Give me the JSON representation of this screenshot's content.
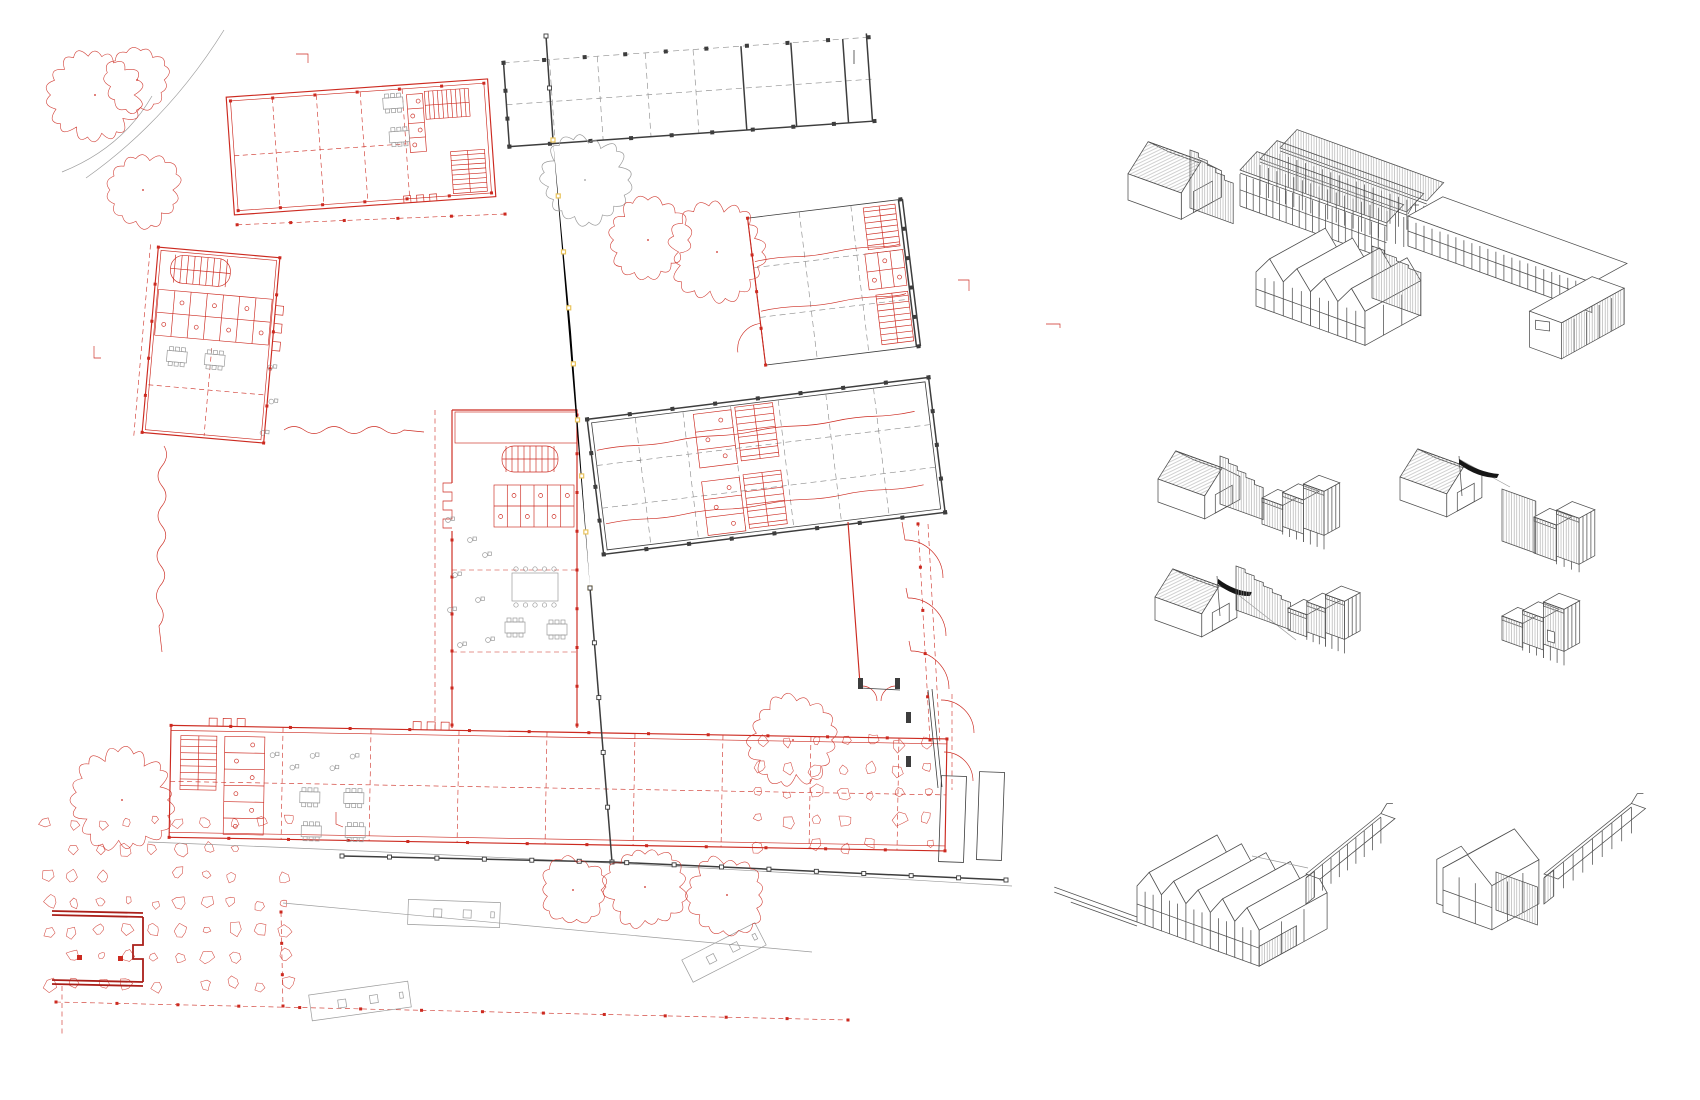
{
  "drawing": {
    "kind": "architectural site plan with axonometric massing studies",
    "visible_text": []
  },
  "colors": {
    "background": "#ffffff",
    "plan_red": "#cc2a20",
    "plan_dark_red": "#aa1f19",
    "boundary_yellow": "#e9c35b",
    "line_black": "#3d3d3d",
    "line_gray": "#9b9b9b",
    "axon_line": "#4e4e4e",
    "axon_hatch": "#a0a0a0",
    "flag_black": "#161616"
  },
  "site_plan": {
    "trees": [
      {
        "x": 95,
        "y": 95,
        "r": 42,
        "c": "red"
      },
      {
        "x": 137,
        "y": 80,
        "r": 30,
        "c": "red"
      },
      {
        "x": 143,
        "y": 190,
        "r": 34,
        "c": "red"
      },
      {
        "x": 585,
        "y": 180,
        "r": 40,
        "c": "gray"
      },
      {
        "x": 648,
        "y": 240,
        "r": 38,
        "c": "red"
      },
      {
        "x": 717,
        "y": 252,
        "r": 44,
        "c": "red"
      },
      {
        "x": 122,
        "y": 800,
        "r": 46,
        "c": "red"
      },
      {
        "x": 793,
        "y": 740,
        "r": 40,
        "c": "red"
      },
      {
        "x": 573,
        "y": 890,
        "r": 30,
        "c": "red"
      },
      {
        "x": 645,
        "y": 887,
        "r": 38,
        "c": "red"
      },
      {
        "x": 727,
        "y": 895,
        "r": 36,
        "c": "red"
      }
    ],
    "paving_fields": [
      {
        "x": 48,
        "y": 822,
        "cols": 10,
        "rows": 7,
        "dx": 26.5,
        "dy": 27,
        "seed": 5
      },
      {
        "x": 760,
        "y": 742,
        "cols": 7,
        "rows": 5,
        "dx": 28,
        "dy": 26,
        "seed": 9
      }
    ],
    "boundary_segments": [
      {
        "pts": [
          [
            546,
            36
          ],
          [
            553,
            140
          ]
        ],
        "cls": "k",
        "post": "ksq",
        "n": 2
      },
      {
        "pts": [
          [
            553,
            140
          ],
          [
            571,
            332
          ],
          [
            590,
            588
          ]
        ],
        "cls": "y",
        "post": "ysq",
        "n": 8
      },
      {
        "pts": [
          [
            590,
            588
          ],
          [
            612,
            862
          ]
        ],
        "cls": "k",
        "post": "ksq",
        "n": 5
      }
    ],
    "fences": [
      {
        "pts": [
          [
            342,
            856
          ],
          [
            612,
            862
          ],
          [
            1006,
            880
          ]
        ],
        "cls": "k",
        "post": "ksq",
        "n": 14
      }
    ],
    "stairs": [
      {
        "g": "gB1",
        "x": 428,
        "y": 96,
        "w": 44,
        "h": 28,
        "n": 9,
        "dir": "v"
      },
      {
        "g": "gB1",
        "x": 450,
        "y": 158,
        "w": 34,
        "h": 42,
        "n": 8,
        "dir": "h"
      },
      {
        "g": "gB3",
        "x": 164,
        "y": 258,
        "w": 60,
        "h": 28,
        "n": 9,
        "dir": "v",
        "rx": 13
      },
      {
        "g": "gMain",
        "x": 502,
        "y": 446,
        "w": 56,
        "h": 26,
        "n": 9,
        "dir": "v",
        "rx": 12
      },
      {
        "g": "gBot",
        "x": 180,
        "y": 742,
        "w": 36,
        "h": 54,
        "n": 8,
        "dir": "h"
      },
      {
        "g": "gB5",
        "x": 742,
        "y": 404,
        "w": 38,
        "h": 54,
        "n": 8,
        "dir": "h"
      },
      {
        "g": "gB5",
        "x": 742,
        "y": 472,
        "w": 38,
        "h": 54,
        "n": 8,
        "dir": "h"
      },
      {
        "g": "gB6",
        "x": 872,
        "y": 212,
        "w": 32,
        "h": 42,
        "n": 7,
        "dir": "h"
      },
      {
        "g": "gB6",
        "x": 874,
        "y": 300,
        "w": 32,
        "h": 50,
        "n": 8,
        "dir": "h"
      }
    ],
    "wcs": [
      {
        "g": "gB1",
        "x": 410,
        "y": 98,
        "w": 16,
        "h": 58,
        "stalls": 4,
        "dir": "v"
      },
      {
        "g": "gB3",
        "x": 154,
        "y": 294,
        "w": 114,
        "h": 46,
        "stalls": 7,
        "dir": "h"
      },
      {
        "g": "gMain",
        "x": 494,
        "y": 485,
        "w": 80,
        "h": 42,
        "stalls": 6,
        "dir": "h"
      },
      {
        "g": "gBot",
        "x": 224,
        "y": 742,
        "w": 40,
        "h": 98,
        "stalls": 6,
        "dir": "v"
      },
      {
        "g": "gB5",
        "x": 700,
        "y": 406,
        "w": 38,
        "h": 54,
        "stalls": 3,
        "dir": "v"
      },
      {
        "g": "gB5",
        "x": 700,
        "y": 474,
        "w": 38,
        "h": 54,
        "stalls": 3,
        "dir": "v"
      },
      {
        "g": "gB6",
        "x": 868,
        "y": 258,
        "w": 38,
        "h": 36,
        "stalls": 3,
        "dir": "h"
      }
    ],
    "tables": [
      {
        "g": "gB1",
        "x": 386,
        "y": 100
      },
      {
        "g": "gB1",
        "x": 390,
        "y": 134
      },
      {
        "g": "gB3",
        "x": 168,
        "y": 354
      },
      {
        "g": "gB3",
        "x": 206,
        "y": 354
      },
      {
        "g": "gMain",
        "x": 505,
        "y": 622
      },
      {
        "g": "gMain",
        "x": 547,
        "y": 624
      },
      {
        "g": "gBot",
        "x": 300,
        "y": 796
      },
      {
        "g": "gBot",
        "x": 344,
        "y": 796
      },
      {
        "g": "gBot",
        "x": 302,
        "y": 830
      },
      {
        "g": "gBot",
        "x": 346,
        "y": 830
      }
    ],
    "big_tables": [
      {
        "g": "gMain",
        "x": 512,
        "y": 573,
        "w": 46,
        "h": 28
      }
    ],
    "chairs": [
      {
        "g": "gMain",
        "x": 448,
        "y": 520
      },
      {
        "g": "gMain",
        "x": 470,
        "y": 540
      },
      {
        "g": "gMain",
        "x": 455,
        "y": 575
      },
      {
        "g": "gMain",
        "x": 485,
        "y": 555
      },
      {
        "g": "gMain",
        "x": 450,
        "y": 610
      },
      {
        "g": "gMain",
        "x": 478,
        "y": 600
      },
      {
        "g": "gMain",
        "x": 460,
        "y": 645
      },
      {
        "g": "gMain",
        "x": 488,
        "y": 640
      },
      {
        "g": "gB3",
        "x": 272,
        "y": 362
      },
      {
        "g": "gB3",
        "x": 276,
        "y": 396
      },
      {
        "g": "gB3",
        "x": 270,
        "y": 428
      },
      {
        "g": "gBot",
        "x": 272,
        "y": 760
      },
      {
        "g": "gBot",
        "x": 292,
        "y": 772
      },
      {
        "g": "gBot",
        "x": 312,
        "y": 760
      },
      {
        "g": "gBot",
        "x": 332,
        "y": 772
      },
      {
        "g": "gBot",
        "x": 352,
        "y": 760
      }
    ],
    "benches": [
      {
        "x": 408,
        "y": 901,
        "w": 92,
        "h": 25,
        "rot": 2
      },
      {
        "x": 310,
        "y": 988,
        "w": 100,
        "h": 26,
        "rot": -8
      },
      {
        "x": 683,
        "y": 940,
        "w": 82,
        "h": 25,
        "rot": -27
      }
    ],
    "post_lines": [
      {
        "g": "gB1",
        "x1": 234,
        "y1": 92,
        "x2": 488,
        "y2": 92,
        "n": 6,
        "cls": "rf",
        "s": 3
      },
      {
        "g": "gB1",
        "x1": 234,
        "y1": 202,
        "x2": 488,
        "y2": 202,
        "n": 6,
        "cls": "rf",
        "s": 3
      },
      {
        "g": "gB1",
        "x1": 232,
        "y1": 216,
        "x2": 500,
        "y2": 224,
        "n": 5,
        "cls": "rf",
        "s": 3
      },
      {
        "g": "gB2",
        "x1": 506,
        "y1": 50,
        "x2": 872,
        "y2": 50,
        "n": 9,
        "cls": "kf",
        "s": 4
      },
      {
        "g": "gB2",
        "x1": 506,
        "y1": 134,
        "x2": 872,
        "y2": 134,
        "n": 9,
        "cls": "kf",
        "s": 4
      },
      {
        "g": "gB2",
        "x1": 506,
        "y1": 50,
        "x2": 506,
        "y2": 134,
        "n": 3,
        "cls": "kf",
        "s": 4
      },
      {
        "g": "gB3",
        "x1": 150,
        "y1": 252,
        "x2": 150,
        "y2": 438,
        "n": 5,
        "cls": "rf",
        "s": 3
      },
      {
        "g": "gB3",
        "x1": 272,
        "y1": 252,
        "x2": 272,
        "y2": 438,
        "n": 5,
        "cls": "rf",
        "s": 3
      },
      {
        "g": "gMain",
        "x1": 577,
        "y1": 415,
        "x2": 577,
        "y2": 725,
        "n": 8,
        "cls": "rf",
        "s": 3
      },
      {
        "g": "gMain",
        "x1": 452,
        "y1": 540,
        "x2": 452,
        "y2": 725,
        "n": 5,
        "cls": "rf",
        "s": 3
      },
      {
        "g": "gBot",
        "x1": 170,
        "y1": 732,
        "x2": 946,
        "y2": 732,
        "n": 13,
        "cls": "rf",
        "s": 3
      },
      {
        "g": "gBot",
        "x1": 170,
        "y1": 844,
        "x2": 946,
        "y2": 844,
        "n": 13,
        "cls": "rf",
        "s": 3
      },
      {
        "g": "gB5",
        "x1": 594,
        "y1": 398,
        "x2": 938,
        "y2": 398,
        "n": 8,
        "cls": "kf",
        "s": 4
      },
      {
        "g": "gB5",
        "x1": 594,
        "y1": 534,
        "x2": 938,
        "y2": 534,
        "n": 8,
        "cls": "kf",
        "s": 4
      },
      {
        "g": "gB5",
        "x1": 594,
        "y1": 398,
        "x2": 594,
        "y2": 534,
        "n": 4,
        "cls": "kf",
        "s": 4
      },
      {
        "g": "gB5",
        "x1": 938,
        "y1": 398,
        "x2": 938,
        "y2": 534,
        "n": 4,
        "cls": "kf",
        "s": 4
      },
      {
        "g": "gB6",
        "x1": 910,
        "y1": 208,
        "x2": 910,
        "y2": 356,
        "n": 5,
        "cls": "kf",
        "s": 4
      },
      {
        "g": "gB6",
        "x1": 756,
        "y1": 208,
        "x2": 756,
        "y2": 356,
        "n": 4,
        "cls": "rf",
        "s": 3
      },
      {
        "g": "gSite",
        "x1": 918,
        "y1": 524,
        "x2": 930,
        "y2": 740,
        "n": 5,
        "cls": "rf",
        "s": 3
      },
      {
        "g": "gSite",
        "x1": 56,
        "y1": 1002,
        "x2": 848,
        "y2": 1020,
        "n": 13,
        "cls": "rf",
        "s": 3
      },
      {
        "g": "gSite",
        "x1": 281,
        "y1": 912,
        "x2": 283,
        "y2": 1006,
        "n": 3,
        "cls": "rf",
        "s": 3
      }
    ],
    "marks": [
      {
        "d": "M94,346 v12 h7",
        "cls": "rt"
      },
      {
        "d": "M296,54 h12 v9",
        "cls": "rt"
      },
      {
        "d": "M854,50 v14",
        "cls": "kt"
      },
      {
        "d": "M958,280 h11 v11",
        "cls": "rt"
      },
      {
        "d": "M336,812 v12 l7,3",
        "cls": "rt"
      },
      {
        "d": "M1046,324 h14 v4",
        "cls": "rt"
      }
    ]
  },
  "axon_panels": [
    {
      "id": "combined-massing",
      "parts": [
        {
          "t": "house",
          "x": 1128,
          "y": 200,
          "s": 1.05
        },
        {
          "t": "stepfence",
          "x": 1190,
          "y": 208,
          "len": 46,
          "h1": 58,
          "h2": 36,
          "steps": 5
        },
        {
          "t": "sheds",
          "x": 1240,
          "y": 206,
          "len": 156,
          "rows": 3,
          "rowdep": 23,
          "h": 36
        },
        {
          "t": "gables",
          "x": 1256,
          "y": 306,
          "n": 4,
          "bay": 29,
          "dep": 64,
          "wall": 34,
          "roof": 18
        },
        {
          "t": "stepfence",
          "x": 1372,
          "y": 298,
          "len": 52,
          "h1": 52,
          "h2": 40,
          "steps": 4
        },
        {
          "t": "flatl",
          "x": 1408,
          "y": 246,
          "len": 196,
          "dep": 40,
          "h": 30,
          "wd": 34,
          "wing": 72
        },
        {
          "t": "tick",
          "x": 1408,
          "y": 214
        }
      ]
    },
    {
      "id": "study-house-fence-blocks",
      "parts": [
        {
          "t": "house",
          "x": 1158,
          "y": 502,
          "s": 0.92
        },
        {
          "t": "stepfence",
          "x": 1220,
          "y": 504,
          "len": 46,
          "h1": 48,
          "h2": 28,
          "steps": 5
        },
        {
          "t": "blocks",
          "x": 1262,
          "y": 524,
          "n": 3,
          "w": 22,
          "hs": [
            26,
            34,
            44
          ],
          "stilts": true,
          "hatch": true
        }
      ]
    },
    {
      "id": "study-house-wire-blocks",
      "parts": [
        {
          "t": "house",
          "x": 1400,
          "y": 500,
          "s": 0.92
        },
        {
          "t": "pole",
          "x": 1462,
          "y": 496,
          "h": 40
        },
        {
          "t": "wire",
          "x1": 1459,
          "y1": 459,
          "x2": 1510,
          "y2": 487
        },
        {
          "t": "flag",
          "x": 1459,
          "y": 459,
          "dx": 40,
          "dy": 15
        },
        {
          "t": "hatchwall",
          "x": 1502,
          "y": 541,
          "len": 36,
          "h": 52
        },
        {
          "t": "blocks",
          "x": 1534,
          "y": 553,
          "n": 2,
          "w": 24,
          "hs": [
            36,
            46
          ],
          "stilts": true,
          "hatch": true
        }
      ]
    },
    {
      "id": "study-house-flag-fence-blocks",
      "parts": [
        {
          "t": "house",
          "x": 1155,
          "y": 620,
          "s": 0.92
        },
        {
          "t": "pole",
          "x": 1220,
          "y": 616,
          "h": 40
        },
        {
          "t": "wire",
          "x1": 1218,
          "y1": 579,
          "x2": 1296,
          "y2": 640
        },
        {
          "t": "flag",
          "x": 1218,
          "y": 579,
          "dx": 34,
          "dy": 13
        },
        {
          "t": "stepfence",
          "x": 1236,
          "y": 610,
          "len": 58,
          "h1": 44,
          "h2": 24,
          "steps": 6
        },
        {
          "t": "blocks",
          "x": 1288,
          "y": 630,
          "n": 3,
          "w": 20,
          "hs": [
            22,
            30,
            38
          ],
          "stilts": true,
          "hatch": true
        }
      ]
    },
    {
      "id": "study-blocks-only",
      "parts": [
        {
          "t": "blocks",
          "x": 1502,
          "y": 640,
          "n": 3,
          "w": 22,
          "hs": [
            24,
            32,
            42
          ],
          "stilts": true,
          "hatch": true,
          "door": true
        }
      ]
    },
    {
      "id": "row-gables-colonnade",
      "parts": [
        {
          "t": "plinth",
          "x": 1137,
          "y": 922,
          "len": 88
        },
        {
          "t": "gables",
          "x": 1137,
          "y": 922,
          "n": 5,
          "bay": 26,
          "dep": 78,
          "wall": 36,
          "roof": 18,
          "endhatch": true
        },
        {
          "t": "wire",
          "x1": 1252,
          "y1": 856,
          "x2": 1308,
          "y2": 868
        },
        {
          "t": "colonnade",
          "x": 1306,
          "y": 902,
          "len": 96,
          "h": 28,
          "tick": true
        }
      ]
    },
    {
      "id": "row-house-fence-colonnade",
      "parts": [
        {
          "t": "gables",
          "x": 1443,
          "y": 912,
          "n": 1,
          "bay": 52,
          "dep": 54,
          "wall": 44,
          "roof": 22,
          "echo": true
        },
        {
          "t": "hatchwall",
          "x": 1496,
          "y": 910,
          "len": 44,
          "h": 38
        },
        {
          "t": "colonnade",
          "x": 1544,
          "y": 902,
          "len": 112,
          "h": 28,
          "tick": true
        }
      ]
    }
  ]
}
